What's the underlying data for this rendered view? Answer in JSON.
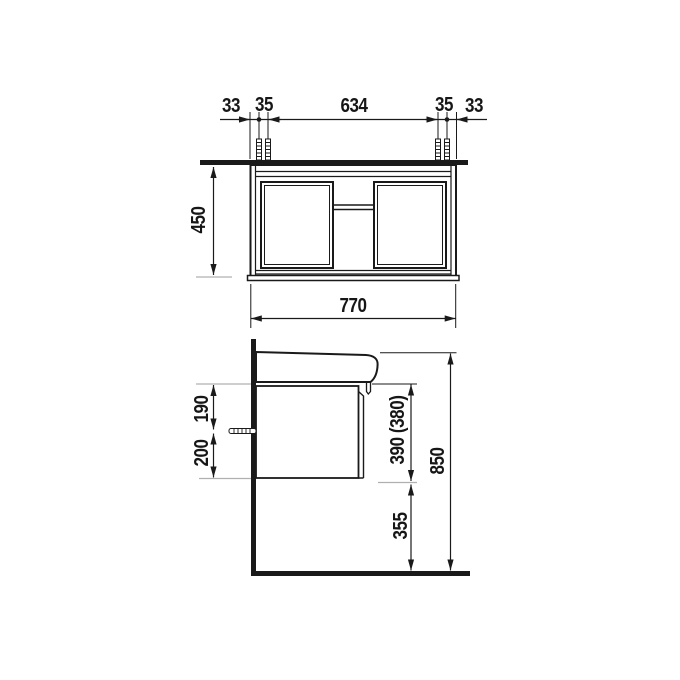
{
  "page": {
    "background": "#ffffff",
    "line_color": "#1a1a1a",
    "extension_color": "#b0b0b0"
  },
  "front_view": {
    "name": "front elevation of vanity unit",
    "dim_left_offset": "33",
    "dim_left_bolt_gap": "35",
    "dim_bolt_span": "634",
    "dim_right_bolt_gap": "35",
    "dim_right_offset": "33",
    "dim_height": "450",
    "dim_width": "770"
  },
  "side_view": {
    "name": "side elevation of vanity unit with washbasin",
    "dim_top_to_screw": "190",
    "dim_screw_to_bottom": "200",
    "dim_body_height": "390 (380)",
    "dim_total_height": "850",
    "dim_floor_clearance": "355"
  }
}
